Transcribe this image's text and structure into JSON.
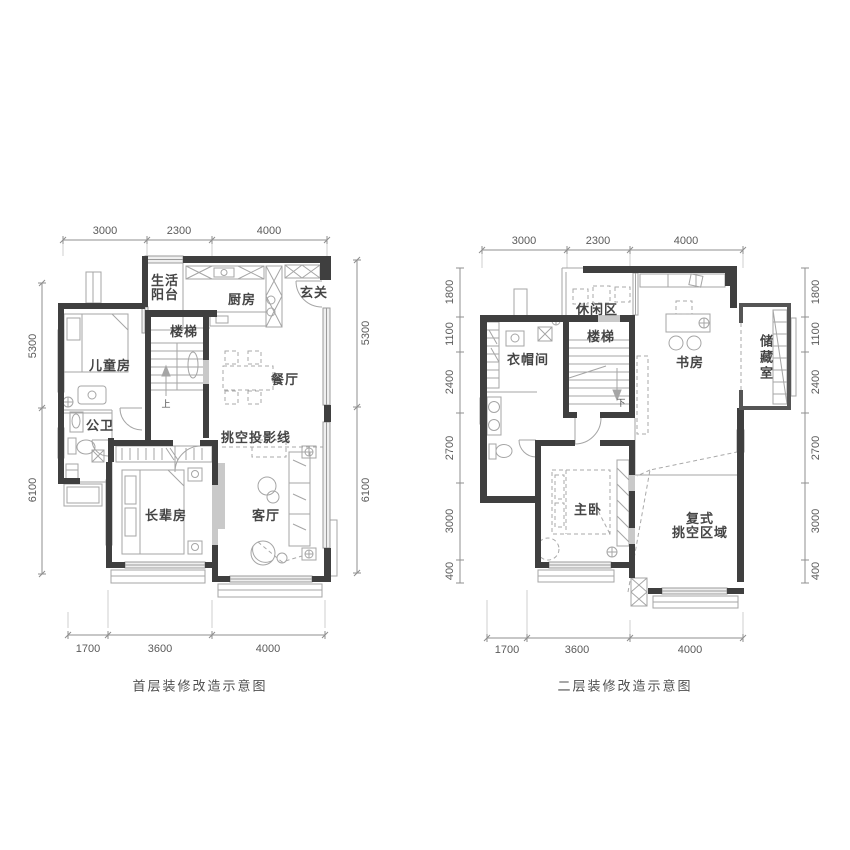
{
  "colors": {
    "wall": "#3f3f3f",
    "thin_line": "#9b9b9b",
    "window_fill": "#efefef",
    "gray_block": "#c9c9c9",
    "dash": "#a9a9a9",
    "dim_line": "#8f8f8f",
    "room_text": "#454545",
    "dim_text": "#5a5a5a"
  },
  "plans": [
    {
      "caption": "首层装修改造示意图",
      "rooms": {
        "balcony_line1": "生活",
        "balcony_line2": "阳台",
        "kitchen": "厨房",
        "entry": "玄关",
        "stairs": "楼梯",
        "kids_room": "儿童房",
        "dining": "餐厅",
        "bath": "公卫",
        "void_line": "挑空投影线",
        "elder_room": "长辈房",
        "living": "客厅",
        "stairs_dir": "上"
      },
      "dims": {
        "top": [
          "3000",
          "2300",
          "4000"
        ],
        "bottom": [
          "1700",
          "3600",
          "4000"
        ],
        "left": [
          "5300",
          "6100"
        ],
        "right": [
          "5300",
          "6100"
        ]
      }
    },
    {
      "caption": "二层装修改造示意图",
      "rooms": {
        "leisure": "休闲区",
        "stairs": "楼梯",
        "cloak": "衣帽间",
        "study": "书房",
        "storage": "储藏室",
        "master": "主卧",
        "void_line1": "复式",
        "void_line2": "挑空区域",
        "stairs_dir": "下"
      },
      "dims": {
        "top": [
          "3000",
          "2300",
          "4000"
        ],
        "bottom": [
          "1700",
          "3600",
          "4000"
        ],
        "left": [
          "1800",
          "1100",
          "2400",
          "2700",
          "3000",
          "400"
        ],
        "right": [
          "1800",
          "1100",
          "2400",
          "2700",
          "3000",
          "400"
        ]
      }
    }
  ]
}
